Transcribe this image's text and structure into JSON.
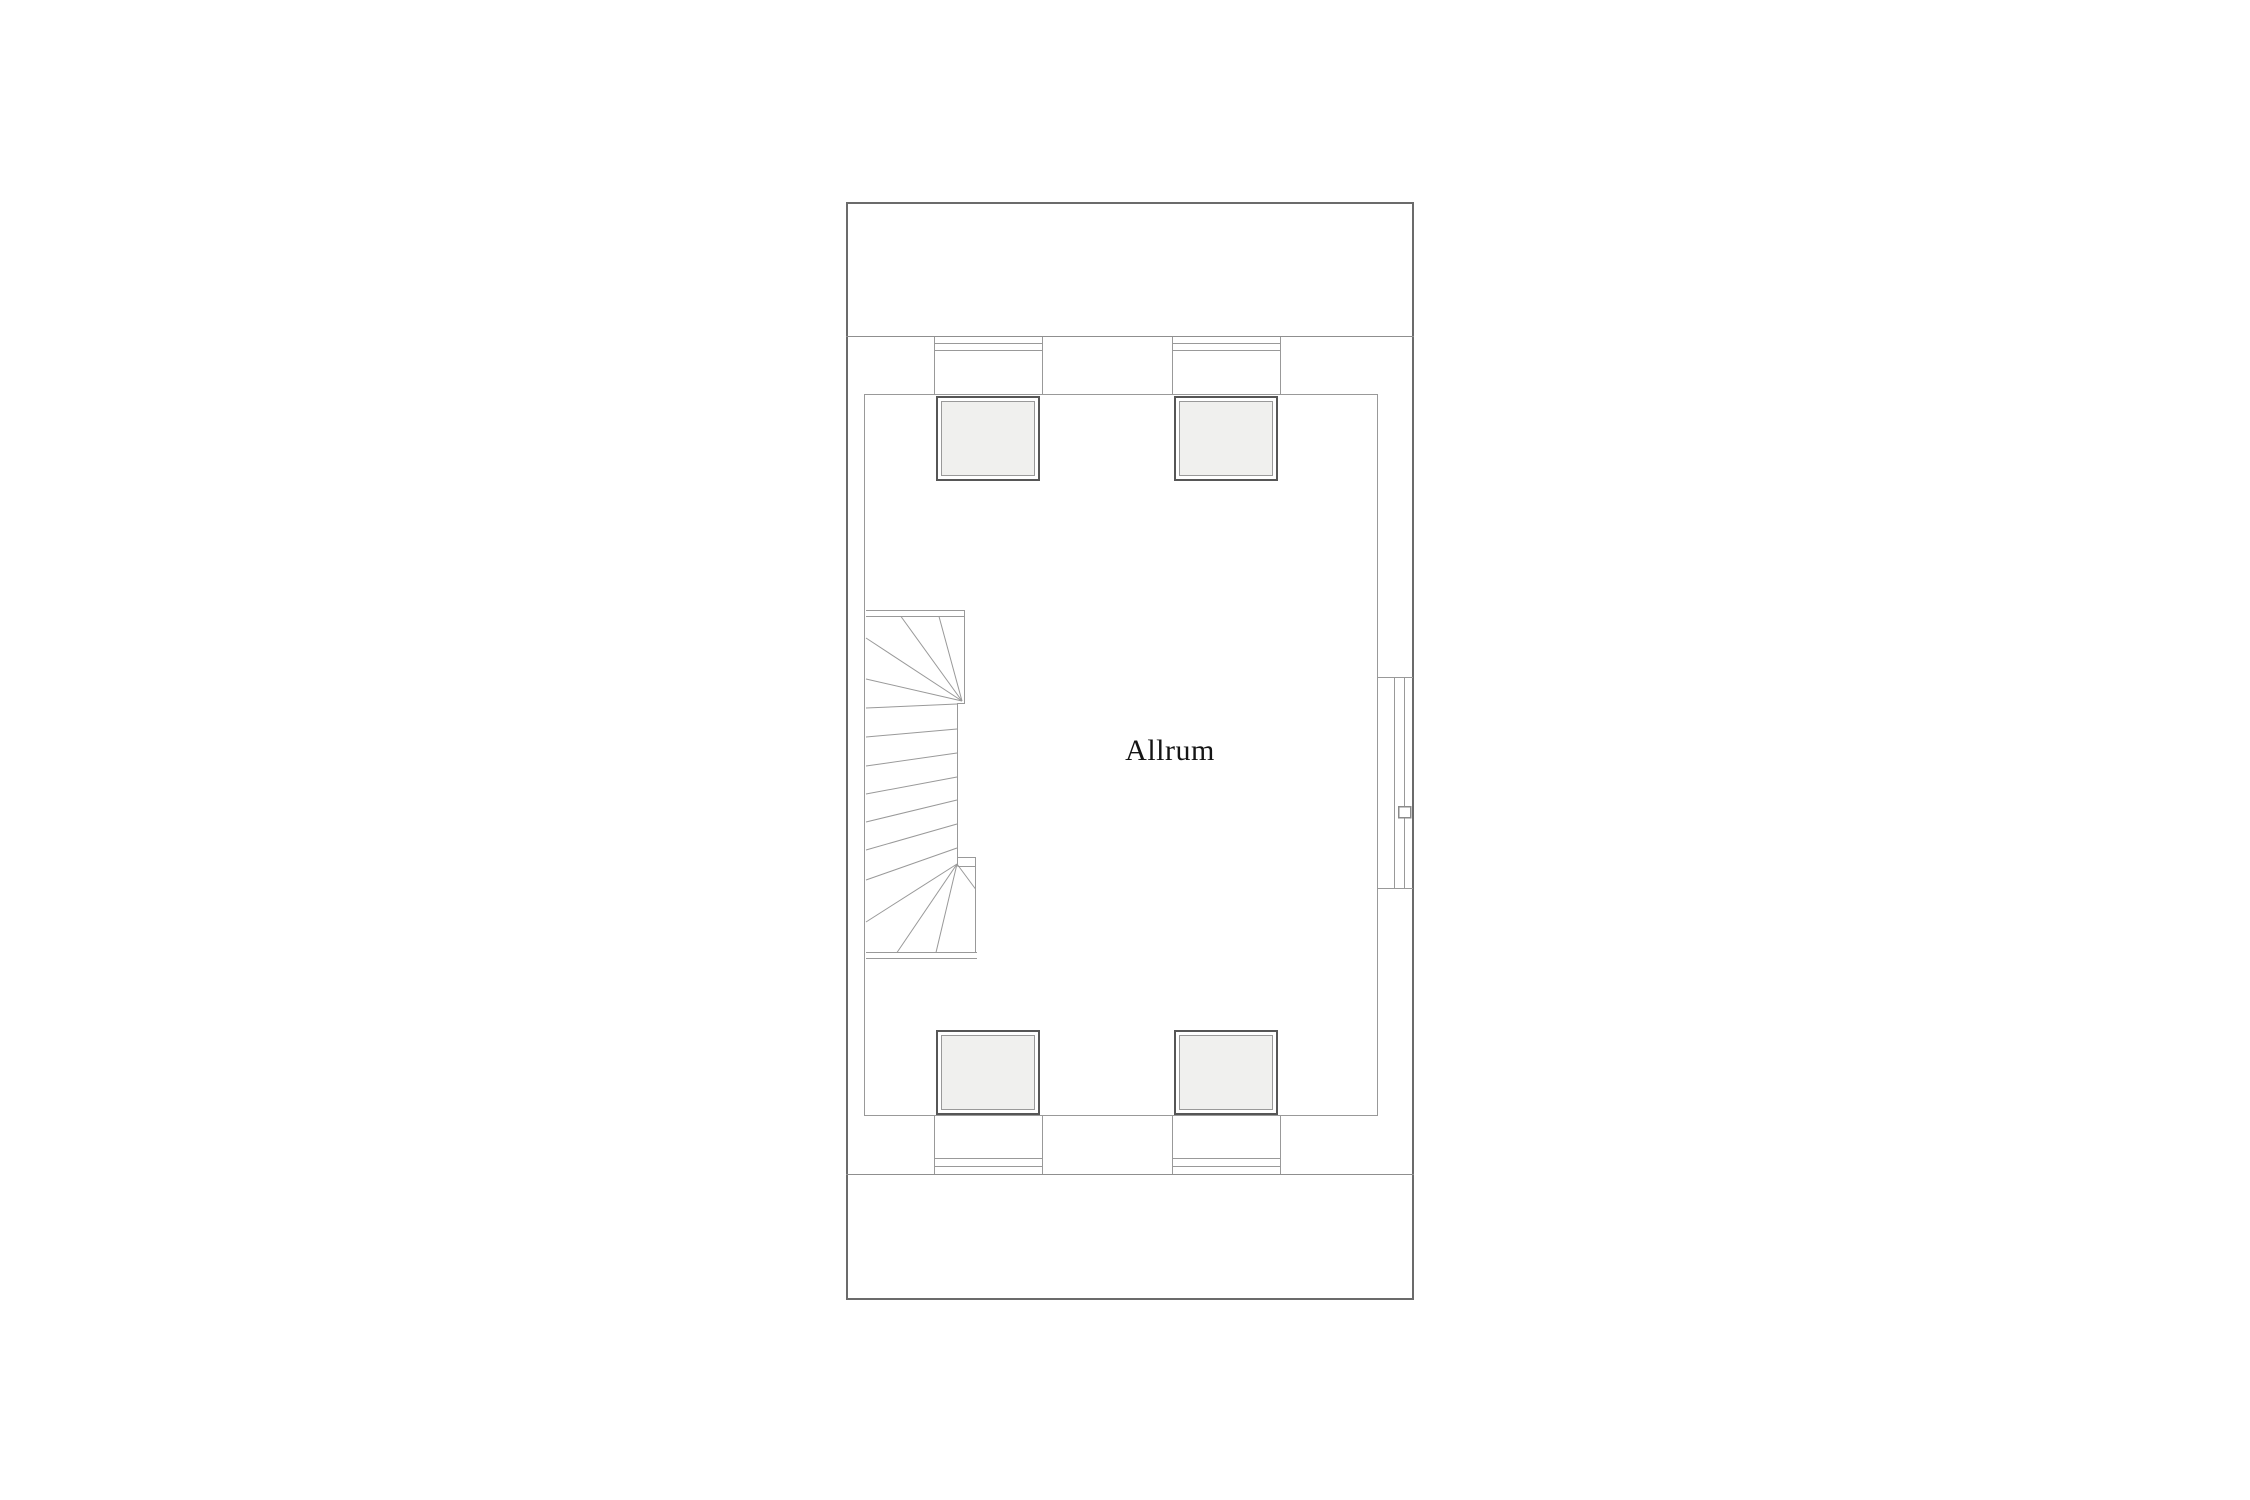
{
  "floor_plan": {
    "room_label": "Allrum"
  },
  "colors": {
    "background": "#ffffff",
    "outer_wall": "#6b6b6b",
    "thin_line": "#999999",
    "band_line": "#8f8f8f",
    "skylight_frame": "#565656",
    "skylight_fill": "#f0f0ee",
    "label_text": "#141414"
  }
}
